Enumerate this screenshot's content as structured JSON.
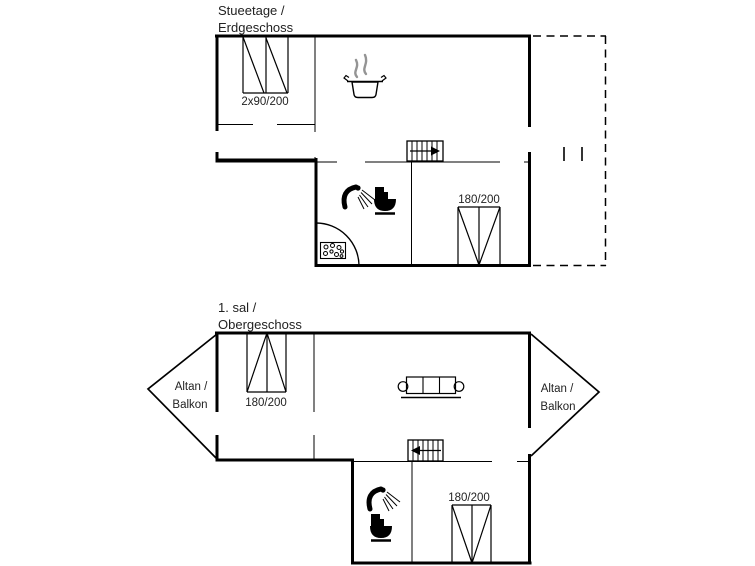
{
  "background": "#ffffff",
  "line_color": "#000000",
  "text_color": "#222222",
  "steam_color": "#949494",
  "ground_floor": {
    "title_line1": "Stueetage /",
    "title_line2": "Erdgeschoss",
    "window_label": "2x90/200",
    "terrace_door_label": "180/200"
  },
  "first_floor": {
    "title_line1": "1. sal /",
    "title_line2": "Obergeschoss",
    "left_balcony_line1": "Altan /",
    "left_balcony_line2": "Balkon",
    "right_balcony_line1": "Altan /",
    "right_balcony_line2": "Balkon",
    "bedroom_window_label": "180/200",
    "lower_window_label": "180/200"
  }
}
